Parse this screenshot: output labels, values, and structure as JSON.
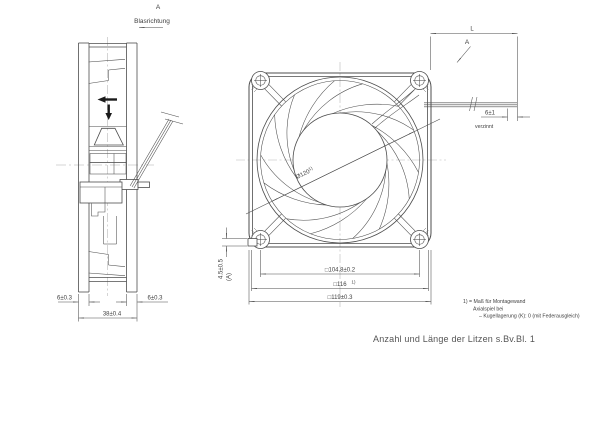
{
  "drawing": {
    "side_view": {
      "view_label": "A",
      "airflow_label": "Blasrichtung",
      "dim_flange_front": "6±0.3",
      "dim_flange_rear": "6±0.3",
      "dim_depth": "38±0.4"
    },
    "front_view": {
      "dim_wall_opening": "Ø120",
      "dim_wall_opening_sup": "1)",
      "dim_hole_pitch": "□104.8±0.2",
      "dim_wall_square": "□116",
      "dim_wall_square_sup": "1)",
      "dim_outer_square": "□119±0.3",
      "dim_corner_pad": "4.5±0.5",
      "dim_corner_pad_ref": "(A)"
    },
    "lead_detail": {
      "dim_length_label": "L",
      "view_arrow_label": "A",
      "dim_tinned_length": "6±1",
      "tinned_label": "verzinnt"
    },
    "notes": {
      "note_1": "1) = Maß für Montagewand",
      "note_2": "Axialspiel bei",
      "note_3": "–  Kugellagerung (K): 0 (mit Federausgleich)"
    },
    "caption": "Anzahl und Länge der Litzen s.Bv.Bl. 1",
    "colors": {
      "line": "#4d4d4d",
      "centerline": "#b8b8b8",
      "text": "#3f3f3f",
      "background": "#ffffff"
    }
  }
}
